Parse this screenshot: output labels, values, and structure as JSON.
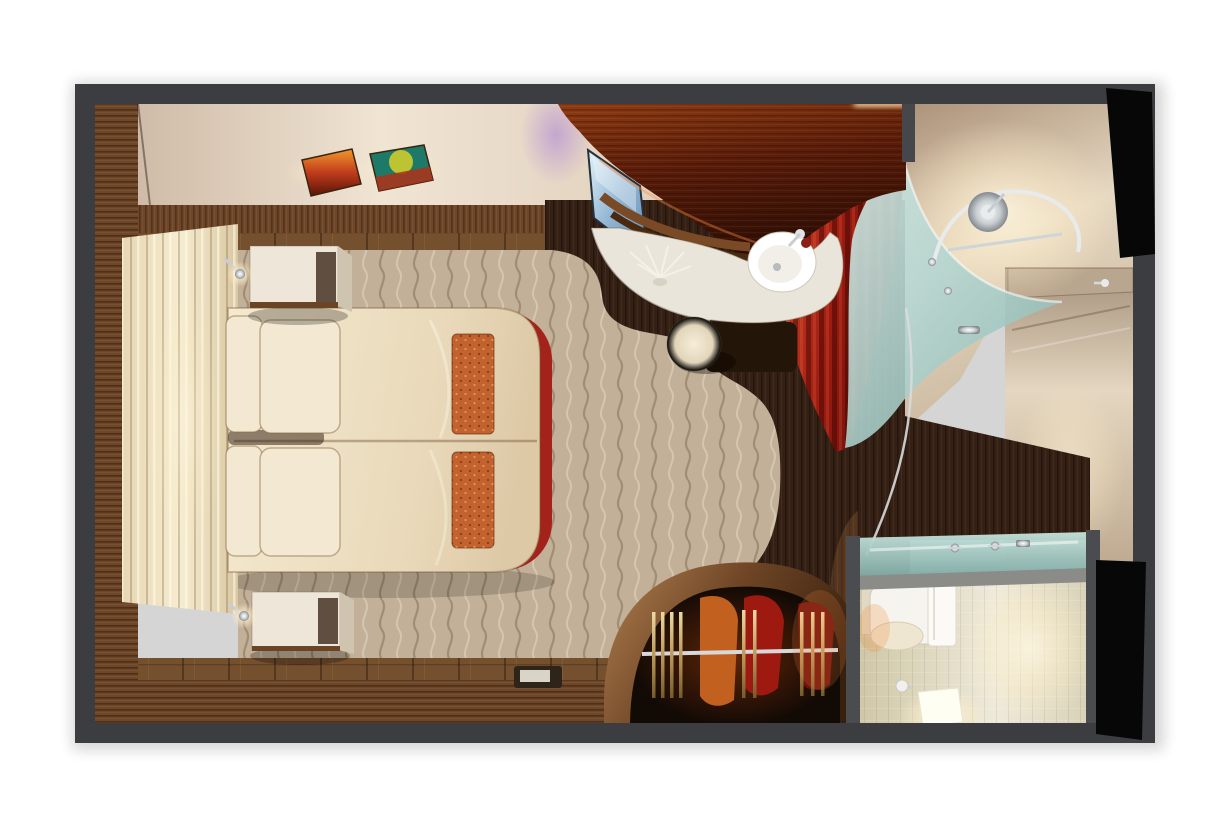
{
  "scene": {
    "type": "3d-render-top-down-cutaway",
    "subject": "cruise ship stateroom floor plan render",
    "rooms": [
      "bedroom",
      "vanity-desk-area",
      "shower-room",
      "entry-hall",
      "toilet-room",
      "wardrobe"
    ],
    "objects": [
      "double-bed",
      "pillows",
      "orange-bed-runners",
      "headboard-panel",
      "nightstand-top",
      "nightstand-bottom",
      "reading-lamps",
      "wall-art-sunset",
      "wall-art-teal",
      "tv-screen",
      "curved-wood-canopy",
      "white-vanity-desk",
      "washbasin",
      "flower-decoration",
      "round-stool",
      "red-privacy-curtain",
      "frosted-glass-shower-screen",
      "shower-rail",
      "shower-head",
      "entry-door",
      "wardrobe-rail",
      "hangers",
      "clothes",
      "glass-vanity-counter",
      "faucet-handles",
      "toilet",
      "towel",
      "toilet-paper-holder",
      "glowing-light-cube",
      "floor-tray"
    ]
  },
  "colors": {
    "background": "#ffffff",
    "wall_frame": "#3b3d40",
    "divider_wall": "#45474b",
    "ceiling": "#e6d6c3",
    "wall_wood": "#6e4628",
    "floor_wood": "#74502e",
    "espresso_floor": "#342015",
    "carpet": "#c2b098",
    "headboard": "#efe3c6",
    "duvet": "#ecdfc4",
    "pillow": "#f3e9d2",
    "runner": "#c2622e",
    "bed_accent_red": "#a3231a",
    "nightstand": "#eee7d9",
    "canopy_wood": "#6b2310",
    "desk": "#eae5da",
    "tv_screen": "#9fc2dc",
    "stool": "#e9dfc8",
    "curtain": "#b02718",
    "shower_glass": "#aacfcb",
    "shower_floor": "#d9c9b2",
    "hall": "#cdbba4",
    "wc_tile": "#ddd6b8",
    "toilet": "#f6f4ee",
    "glow_cube": "#fffef2",
    "chrome": "#d7dadc",
    "black_door": "#070707",
    "art_sunset": "#c03c1c",
    "art_teal": "#1d7a68",
    "violet_glow": "#9f7fd0"
  }
}
